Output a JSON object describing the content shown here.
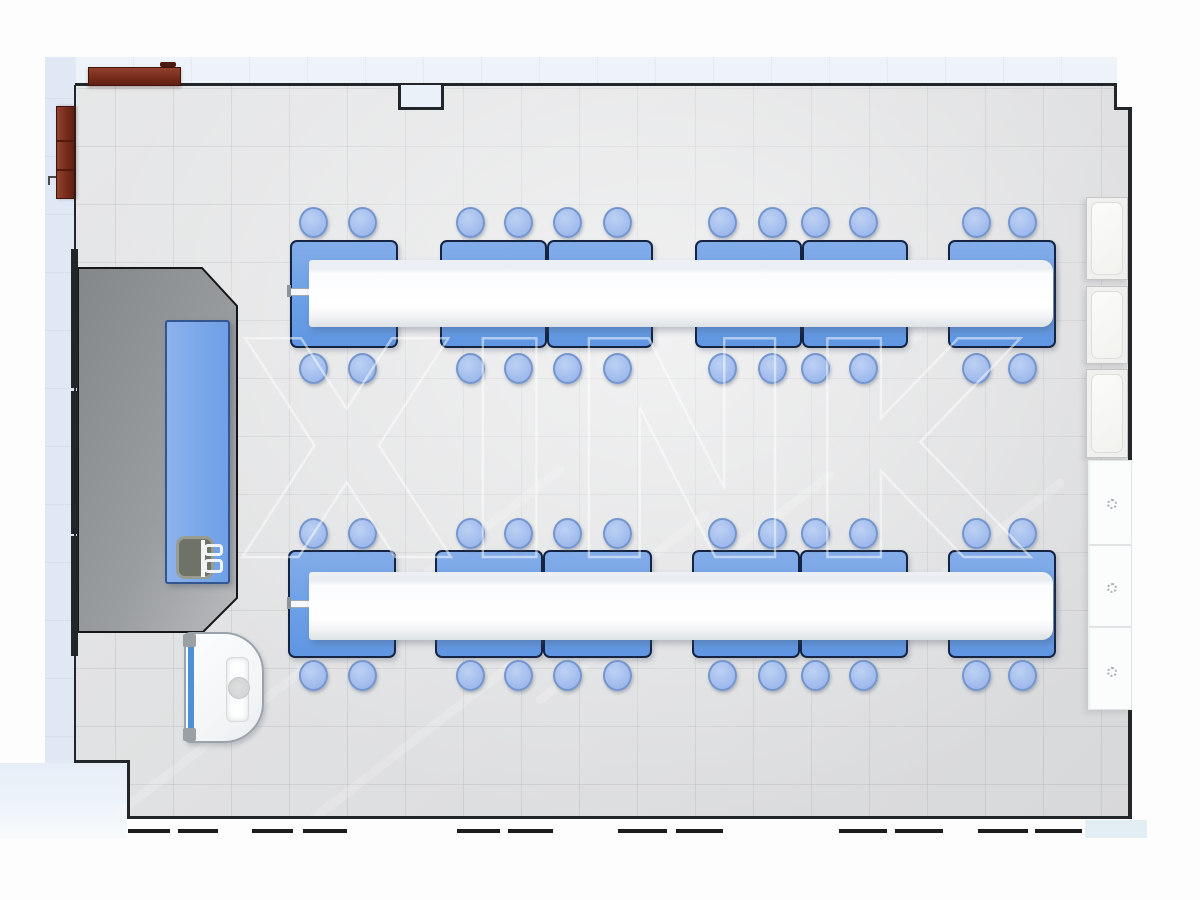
{
  "watermark": {
    "text": "XINK"
  },
  "palette": {
    "bench_blue": "#6ba0e6",
    "stool_blue": "#a3bdee",
    "shelf_white": "#ffffff",
    "floor_gray": "#e0e1e2",
    "platform_gray": "#9a9da0",
    "wall_dark": "#22262a",
    "cabinet_brown": "#7c2f1d",
    "outside_blue": "#dfe8f4",
    "sink_accent_blue": "#4d90d6",
    "watermark_white": "#ffffff"
  },
  "floorplan": {
    "outside": [
      {
        "name": "outside-left-strip",
        "cls": "outside-left",
        "x": 45,
        "y": 57,
        "w": 30,
        "h": 738
      },
      {
        "name": "outside-top-strip",
        "cls": "outside-top",
        "x": 75,
        "y": 57,
        "w": 1042,
        "h": 26
      },
      {
        "name": "outside-bottom-left",
        "cls": "outside-bl",
        "x": 0,
        "y": 763,
        "w": 127,
        "h": 76
      },
      {
        "name": "outside-bottom-right",
        "cls": "outside-br",
        "x": 1085,
        "y": 820,
        "w": 62,
        "h": 18
      }
    ],
    "floor": {
      "clip": "polygon(75px 85px, 1117px 85px, 1117px 110px, 1131px 110px, 1131px 818px, 127px 818px, 127px 762px, 75px 762px)"
    },
    "walls": [
      {
        "name": "wall-top",
        "x": 75,
        "y": 83,
        "w": 1042,
        "h": 3
      },
      {
        "name": "wall-top-right-step-v",
        "x": 1114,
        "y": 83,
        "w": 3,
        "h": 27
      },
      {
        "name": "wall-top-right-step-h",
        "x": 1114,
        "y": 107,
        "w": 18,
        "h": 3
      },
      {
        "name": "wall-right",
        "x": 1128,
        "y": 107,
        "w": 4,
        "h": 711
      },
      {
        "name": "wall-bottom",
        "x": 127,
        "y": 816,
        "w": 1005,
        "h": 3
      },
      {
        "name": "wall-bottom-left-step-v",
        "x": 127,
        "y": 761,
        "w": 3,
        "h": 57
      },
      {
        "name": "wall-bottom-left-step-h",
        "x": 74,
        "y": 760,
        "w": 56,
        "h": 3
      },
      {
        "name": "wall-left",
        "x": 74,
        "y": 85,
        "w": 2,
        "h": 676
      },
      {
        "name": "wall-left-door-frame-1",
        "x": 71,
        "y": 249,
        "w": 7,
        "h": 139
      },
      {
        "name": "wall-left-door-frame-2",
        "x": 71,
        "y": 391,
        "w": 7,
        "h": 143
      },
      {
        "name": "wall-left-door-frame-3",
        "x": 71,
        "y": 536,
        "w": 7,
        "h": 120
      }
    ],
    "notch": {
      "name": "wall-top-recess",
      "x": 398,
      "y": 85,
      "w": 46,
      "h": 25
    },
    "platform": {
      "points": "78,268 202,268 237,306 237,598 203,632 78,632"
    },
    "streaks": [
      {
        "x1": 120,
        "y1": 812,
        "x2": 560,
        "y2": 470
      },
      {
        "x1": 260,
        "y1": 860,
        "x2": 705,
        "y2": 515
      },
      {
        "x1": 540,
        "y1": 700,
        "x2": 830,
        "y2": 475
      },
      {
        "x1": 865,
        "y1": 635,
        "x2": 1060,
        "y2": 483
      },
      {
        "x1": 905,
        "y1": 345,
        "x2": 1030,
        "y2": 250
      }
    ],
    "teacher_bench": {
      "x": 165,
      "y": 320,
      "w": 65,
      "h": 264
    },
    "demo_sink": {
      "x": 176,
      "y": 536,
      "w": 38,
      "h": 43
    },
    "faucet": {
      "pipe": {
        "x": 201,
        "y": 540,
        "w": 4,
        "h": 37
      },
      "loops": [
        {
          "x": 204,
          "y": 544,
          "w": 19,
          "h": 12
        },
        {
          "x": 204,
          "y": 559,
          "w": 19,
          "h": 14
        }
      ]
    },
    "sink_station": {
      "body": {
        "x": 184,
        "y": 632,
        "w": 80,
        "h": 111
      },
      "strip": {
        "x": 188,
        "y": 646,
        "w": 6,
        "h": 86
      },
      "caps": [
        {
          "x": 183,
          "y": 634,
          "w": 13,
          "h": 13
        },
        {
          "x": 183,
          "y": 728,
          "w": 13,
          "h": 13
        }
      ],
      "panel": {
        "x": 226,
        "y": 657,
        "w": 23,
        "h": 65
      },
      "drain": {
        "x": 228,
        "y": 677,
        "w": 22,
        "h": 22
      }
    },
    "benches": [
      {
        "x": 290,
        "y": 240,
        "w": 108,
        "h": 108
      },
      {
        "x": 440,
        "y": 240,
        "w": 107,
        "h": 108
      },
      {
        "x": 547,
        "y": 240,
        "w": 106,
        "h": 108
      },
      {
        "x": 695,
        "y": 240,
        "w": 107,
        "h": 108
      },
      {
        "x": 802,
        "y": 240,
        "w": 106,
        "h": 108
      },
      {
        "x": 948,
        "y": 240,
        "w": 108,
        "h": 108
      },
      {
        "x": 288,
        "y": 550,
        "w": 108,
        "h": 108
      },
      {
        "x": 435,
        "y": 550,
        "w": 108,
        "h": 108
      },
      {
        "x": 543,
        "y": 550,
        "w": 109,
        "h": 108
      },
      {
        "x": 692,
        "y": 550,
        "w": 108,
        "h": 108
      },
      {
        "x": 800,
        "y": 550,
        "w": 108,
        "h": 108
      },
      {
        "x": 948,
        "y": 550,
        "w": 108,
        "h": 108
      }
    ],
    "shelves": [
      {
        "x": 309,
        "y": 260,
        "w": 744,
        "h": 67
      },
      {
        "x": 309,
        "y": 572,
        "w": 744,
        "h": 68
      }
    ],
    "rods": [
      {
        "x": 289,
        "y": 288,
        "w": 21,
        "h": 8,
        "capx": 287,
        "capy": 285
      },
      {
        "x": 289,
        "y": 600,
        "w": 21,
        "h": 8,
        "capx": 287,
        "capy": 597
      }
    ],
    "stools": {
      "w": 29,
      "h": 31,
      "cxs": [
        313,
        362,
        470,
        518,
        567,
        617,
        722,
        772,
        815,
        863,
        976,
        1022
      ],
      "cys": [
        222,
        368,
        533,
        675
      ]
    },
    "wall_cabinets": {
      "x": 1086,
      "w": 42,
      "items": [
        {
          "y": 197,
          "h": 83
        },
        {
          "y": 286,
          "h": 78
        },
        {
          "y": 369,
          "h": 89
        }
      ]
    },
    "base_cabinets": {
      "x": 1088,
      "w": 44,
      "knob_cx": 1112,
      "knob_d": 10,
      "items": [
        {
          "y": 460,
          "h": 85,
          "knob_cy": 504
        },
        {
          "y": 545,
          "h": 82,
          "knob_cy": 588
        },
        {
          "y": 627,
          "h": 83,
          "knob_cy": 672
        }
      ]
    },
    "brown_cabinets": {
      "top": {
        "x": 88,
        "y": 67,
        "w": 93,
        "h": 19
      },
      "top_handle": {
        "x": 160,
        "y": 62,
        "w": 16,
        "h": 5
      },
      "left": {
        "x": 56,
        "y": 106,
        "w": 19,
        "h": 93
      },
      "left_lines": [
        {
          "x": 57,
          "y": 140,
          "w": 17,
          "h": 2
        },
        {
          "x": 57,
          "y": 169,
          "w": 17,
          "h": 2
        }
      ],
      "hooks": [
        {
          "x": 48,
          "y": 176,
          "w": 8,
          "h": 2
        },
        {
          "x": 48,
          "y": 176,
          "w": 2,
          "h": 9
        }
      ]
    },
    "window_dashes": {
      "y": 829,
      "h": 4,
      "segments": [
        [
          128,
          42
        ],
        [
          178,
          40
        ],
        [
          252,
          41
        ],
        [
          303,
          44
        ],
        [
          457,
          43
        ],
        [
          508,
          45
        ],
        [
          618,
          49
        ],
        [
          676,
          47
        ],
        [
          839,
          48
        ],
        [
          895,
          48
        ],
        [
          978,
          50
        ],
        [
          1035,
          47
        ]
      ]
    }
  }
}
